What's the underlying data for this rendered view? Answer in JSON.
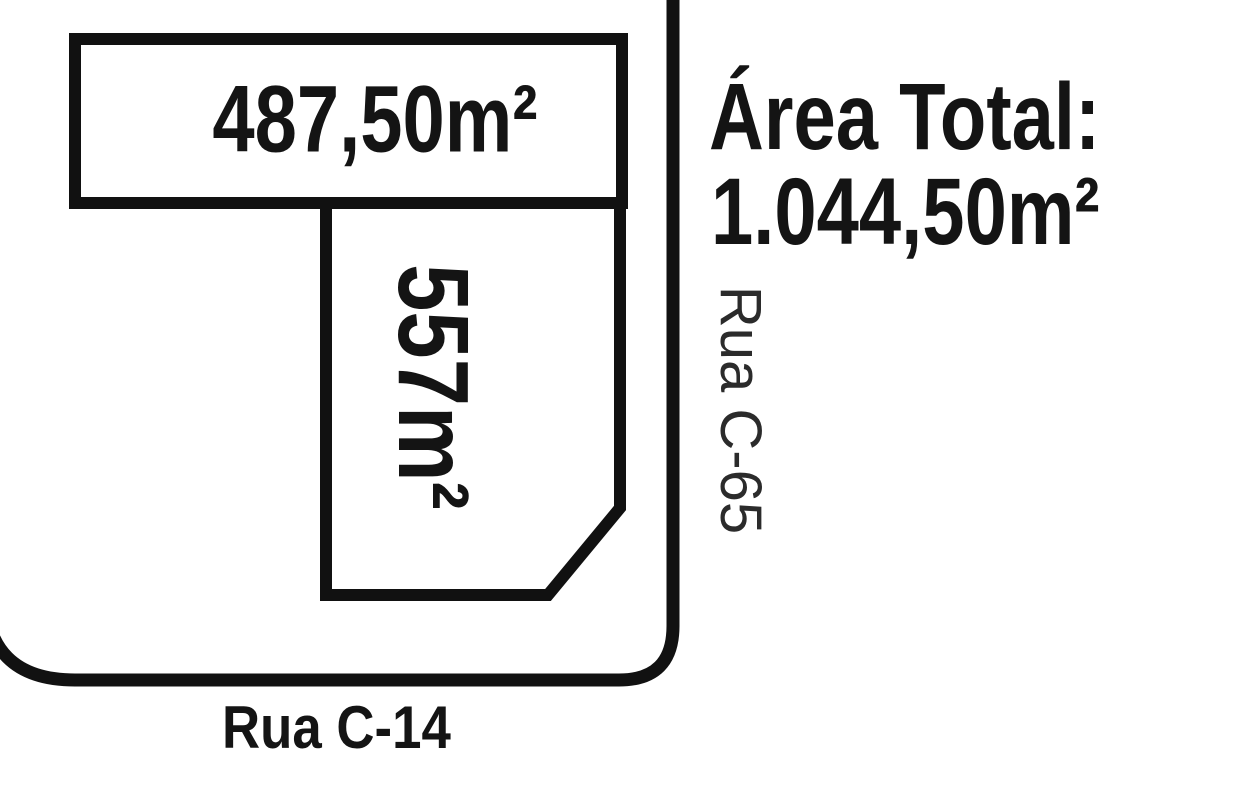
{
  "diagram": {
    "plot_top": {
      "area": "487,50m²"
    },
    "plot_bottom": {
      "area": "557m²"
    },
    "area_total": {
      "title": "Área Total:",
      "value": "1.044,50m²"
    },
    "street_right": "Rua C-65",
    "street_bottom": "Rua C-14",
    "colors": {
      "line": "#111111",
      "background": "#ffffff",
      "text": "#141414"
    }
  }
}
